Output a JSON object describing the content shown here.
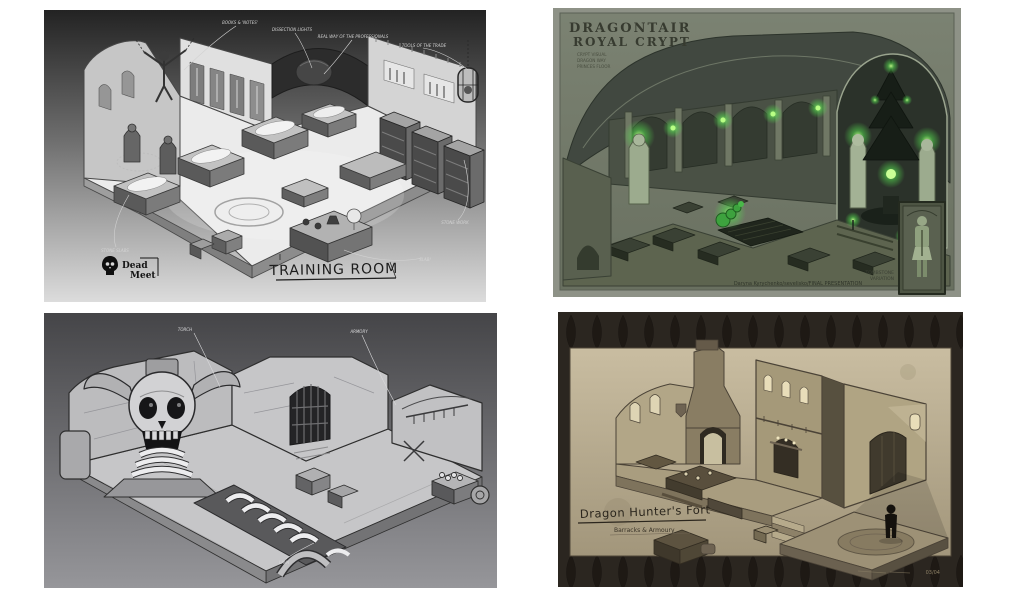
{
  "collage": {
    "background": "#ffffff"
  },
  "training_room": {
    "logo_top": "Dead",
    "logo_bottom": "Meet",
    "title": "TRAINING ROOM",
    "ann_books": "BOOKS & 'NOTES'",
    "ann_lights": "DISSECTION LIGHTS",
    "ann_real_way": "REAL WAY OF THE PROFESSIONALS",
    "ann_tools": "TOOLS OF THE TRADE",
    "ann_stone_slabs": "STONE SLABS",
    "ann_stone_work": "STONE WORK",
    "ann_slab": "SLAB!"
  },
  "royal_crypt": {
    "title_line1": "DRAGONTAIR",
    "title_line2": "ROYAL CRYPT",
    "subtitle_line1": "CRYPT VISUAL",
    "subtitle_line2": "DRAGON WAY",
    "subtitle_line3": "PRINCES FLOOR",
    "inset_line1": "TOMBSTONE",
    "inset_line2": "VARIATION",
    "credit": "Daryna Kyrychenko/sevelisko/FINAL PRESENTATION"
  },
  "skull_dungeon": {
    "ann_torch": "TORCH",
    "ann_armory": "ARMORY",
    "ann_lava": "LAVA"
  },
  "hunters_fort": {
    "title": "Dragon Hunter's Fort",
    "subtitle": "Barracks & Armoury",
    "corner_note": "03/04"
  }
}
